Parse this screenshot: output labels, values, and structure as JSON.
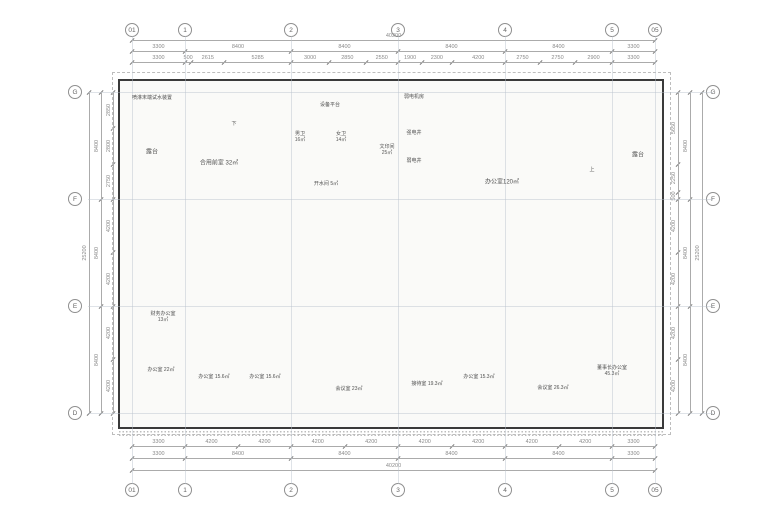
{
  "drawing": {
    "type": "office-floor-plan"
  },
  "grid": {
    "top_labels": [
      "01",
      "1",
      "2",
      "3",
      "4",
      "5",
      "05"
    ],
    "bottom_labels": [
      "01",
      "1",
      "2",
      "3",
      "4",
      "5",
      "05"
    ],
    "left_labels": [
      "G",
      "F",
      "E",
      "D"
    ],
    "right_labels": [
      "G",
      "F",
      "E",
      "D"
    ]
  },
  "dimensions": {
    "top_overall": "40200",
    "top_bays": [
      "3300",
      "8400",
      "8400",
      "8400",
      "8400",
      "3300"
    ],
    "top_subs": [
      "3300",
      "500",
      "2615",
      "5285",
      "3000",
      "2850",
      "2550",
      "1900",
      "2300",
      "4200",
      "2750",
      "2750",
      "2900",
      "3300"
    ],
    "bottom_overall": "40200",
    "bottom_bays": [
      "3300",
      "8400",
      "8400",
      "8400",
      "8400",
      "3300"
    ],
    "bottom_subs": [
      "3300",
      "4200",
      "4200",
      "4200",
      "4200",
      "4200",
      "4200",
      "4200",
      "4200",
      "3300"
    ],
    "left_overall": "25200",
    "left_bays": [
      "8400",
      "8400",
      "8400"
    ],
    "left_subs": [
      "2850",
      "2800",
      "2750",
      "4200",
      "4200",
      "4200",
      "4200"
    ],
    "right_overall": "25200",
    "right_bays": [
      "8400",
      "8400",
      "8400"
    ],
    "right_subs": [
      "5650",
      "2250",
      "500",
      "4200",
      "4200",
      "4200",
      "4200"
    ]
  },
  "rooms": {
    "terrace_left": {
      "label": "露台"
    },
    "terrace_right": {
      "label": "露台"
    },
    "sprinkler_note": {
      "label": "喷淋末端试水装置"
    },
    "shared_lobby": {
      "label": "合用前室",
      "area": "32㎡"
    },
    "equipment_platform": {
      "label": "设备平台"
    },
    "mens_wc": {
      "label": "男卫",
      "area": "16㎡"
    },
    "womens_wc": {
      "label": "女卫",
      "area": "14㎡"
    },
    "water_room": {
      "label": "开水间",
      "area": "5㎡"
    },
    "print_room": {
      "label": "文印间",
      "area": "25㎡"
    },
    "elec_room": {
      "label": "弱电机房"
    },
    "strong_shaft": {
      "label": "强电井"
    },
    "weak_shaft": {
      "label": "弱电井"
    },
    "office_top": {
      "label": "办公室",
      "area": "120㎡"
    },
    "finance_office": {
      "label": "财务办公室",
      "area": "13㎡"
    },
    "office_22": {
      "label": "办公室",
      "area": "22㎡"
    },
    "office_a": {
      "label": "办公室",
      "area": "15.6㎡"
    },
    "office_b": {
      "label": "办公室",
      "area": "15.6㎡"
    },
    "meeting_1": {
      "label": "会议室",
      "area": "23㎡"
    },
    "reception": {
      "label": "接待室",
      "area": "19.3㎡"
    },
    "office_c": {
      "label": "办公室",
      "area": "15.3㎡"
    },
    "meeting_2": {
      "label": "会议室",
      "area": "26.3㎡"
    },
    "chairman": {
      "label": "董事长办公室",
      "area": "45.3㎡"
    }
  },
  "stairs": {
    "up": "上",
    "down": "下"
  },
  "icons": {
    "flower": "✳"
  },
  "colors": {
    "tan_room": "#c9ae90",
    "teal_room": "#9ccad2",
    "wood_room": "#c19a6f",
    "planter_green": "#b9d59c",
    "column": "#0b0b0b",
    "wall": "#3a3a3a",
    "dim_text": "#8b8b8b"
  }
}
